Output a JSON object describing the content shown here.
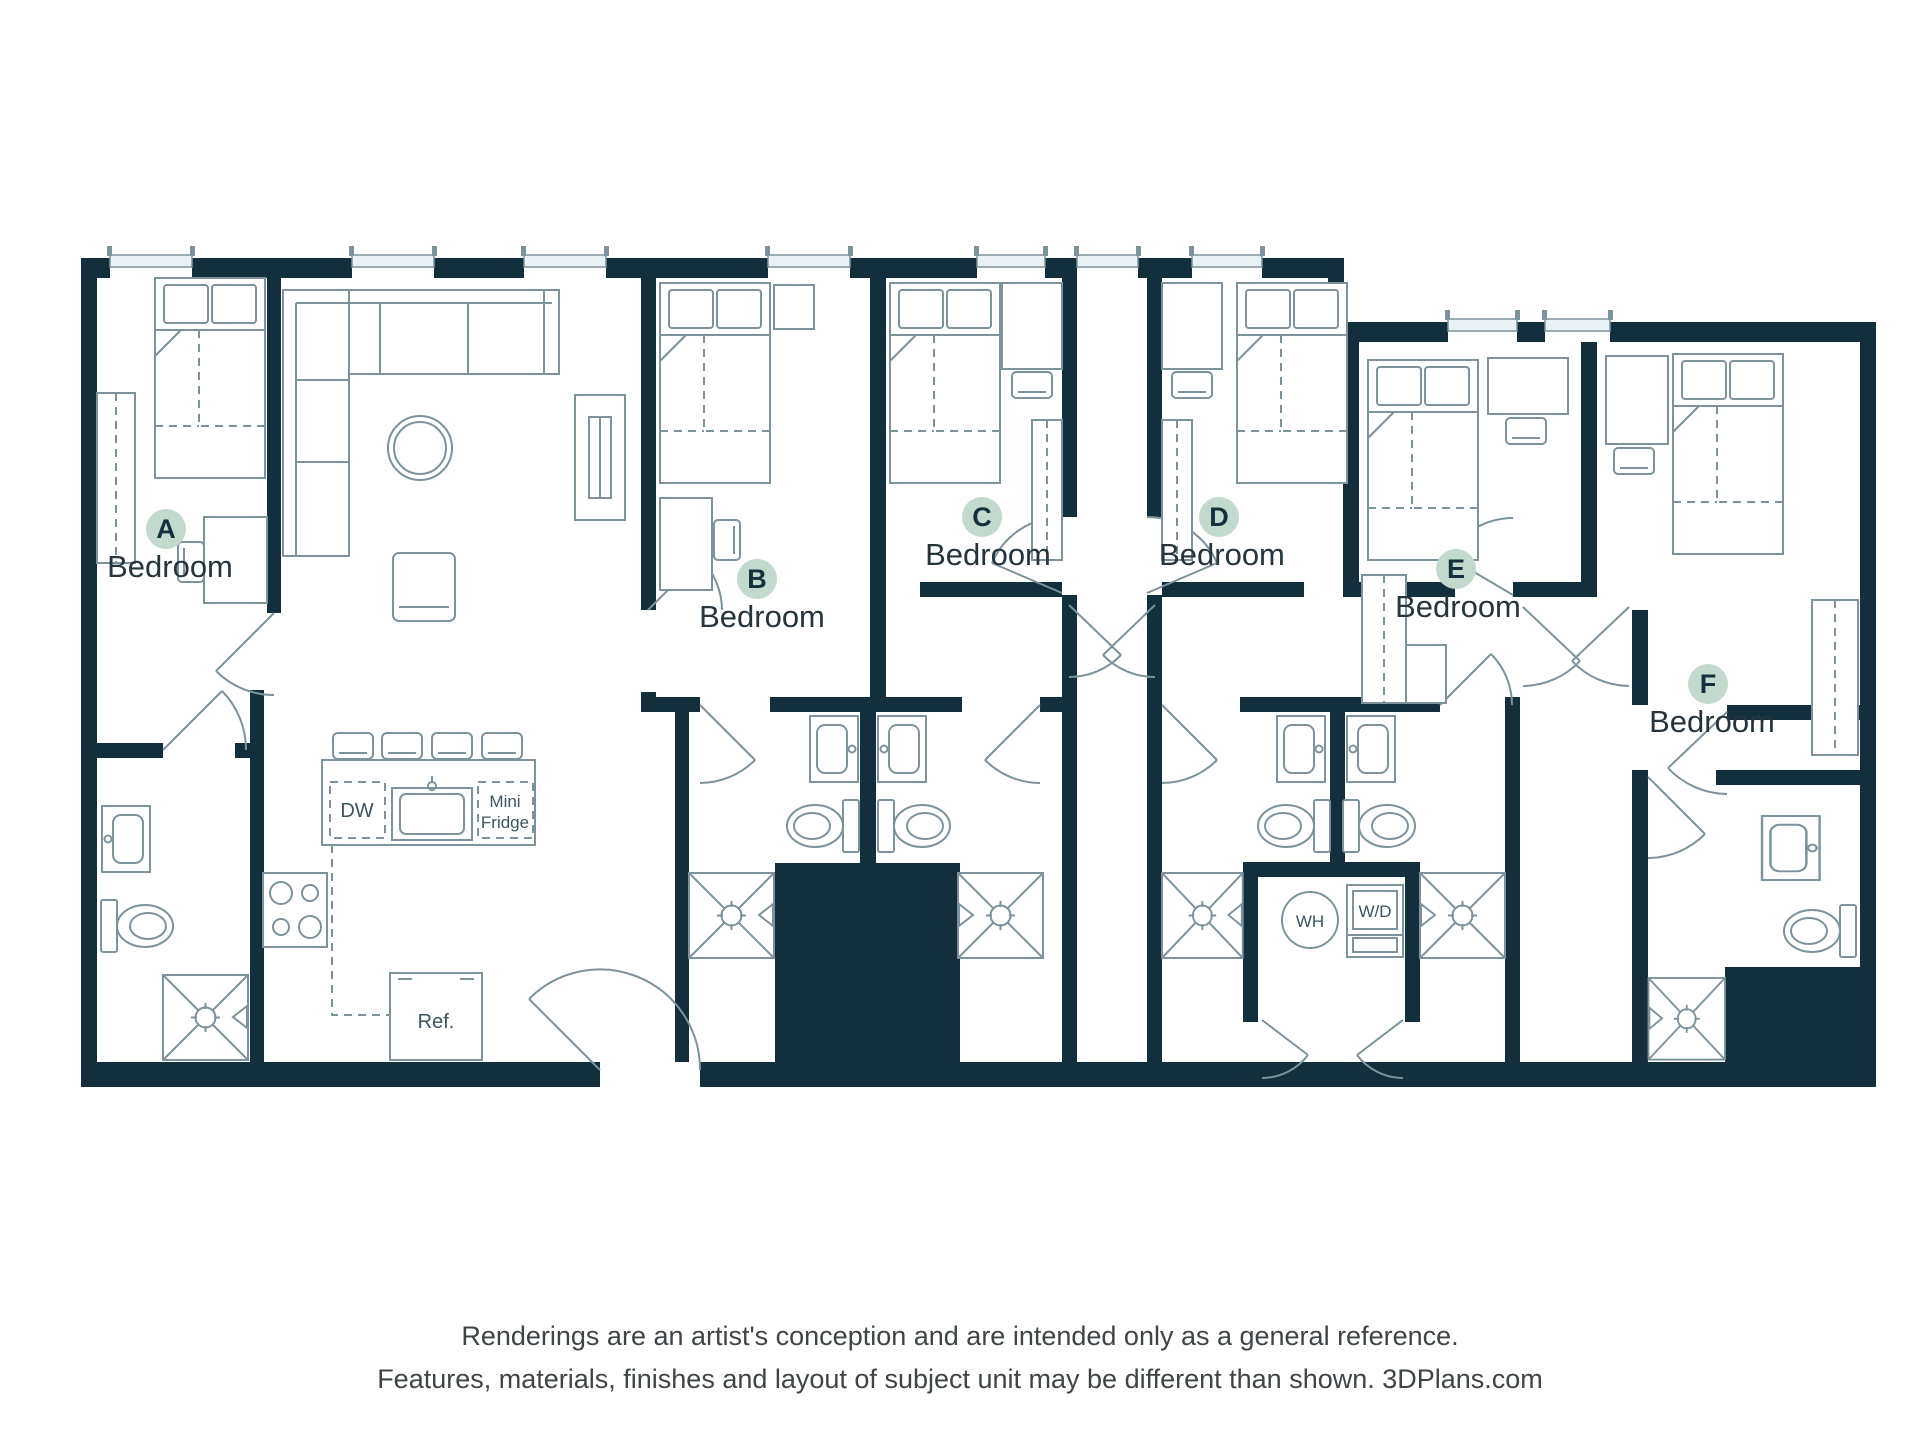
{
  "floor_plan": {
    "bedrooms": [
      {
        "letter": "A",
        "label": "Bedroom"
      },
      {
        "letter": "B",
        "label": "Bedroom"
      },
      {
        "letter": "C",
        "label": "Bedroom"
      },
      {
        "letter": "D",
        "label": "Bedroom"
      },
      {
        "letter": "E",
        "label": "Bedroom"
      },
      {
        "letter": "F",
        "label": "Bedroom"
      }
    ],
    "kitchen": {
      "dishwasher_label": "DW",
      "mini_fridge_line1": "Mini",
      "mini_fridge_line2": "Fridge",
      "refrigerator_label": "Ref."
    },
    "laundry": {
      "water_heater_label": "WH",
      "washer_dryer_label": "W/D"
    }
  },
  "footer": {
    "line1": "Renderings are an artist's conception and are intended only as a general reference.",
    "line2": "Features, materials, finishes and layout of subject unit may be different than shown. 3DPlans.com"
  },
  "colors": {
    "wall": "#132f3b",
    "line": "#7d929b",
    "badge": "#c3d9cd",
    "badge_text": "#14303c",
    "label_text": "#26343c",
    "glass": "#e9f1f4",
    "footer_text": "#3f4447"
  }
}
